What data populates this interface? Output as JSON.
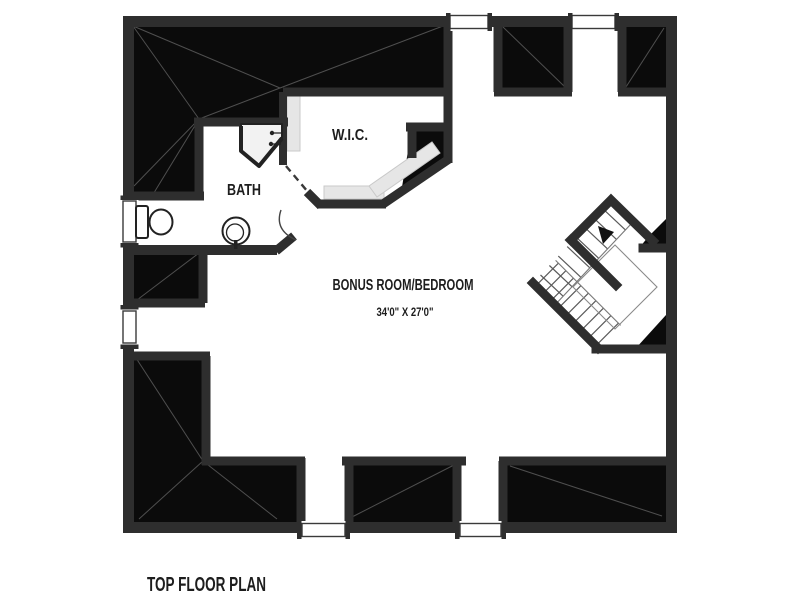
{
  "plan": {
    "name_label": "TOP FLOOR PLAN",
    "rooms": {
      "bath": {
        "label": "BATH"
      },
      "wic": {
        "label": "W.I.C."
      },
      "bonus": {
        "label": "BONUS ROOM/BEDROOM",
        "dimensions": "34'0\" X 27'0\""
      }
    },
    "fixtures": {
      "toilet": "toilet",
      "sink": "pedestal-sink",
      "shower": "corner-shower",
      "stairs": "switchback-staircase",
      "stair_arrow": "up-direction-arrow",
      "closet_shelving": "wic-shelves"
    },
    "window_count": 6,
    "colors": {
      "wall": "#2e2e2e",
      "attic": "#0b0b0b",
      "ridge_line": "#4f4f4f",
      "shelf": "#e6e6e6",
      "shower_fill": "#f2f2f2",
      "text": "#1d1d1d",
      "background": "#ffffff"
    }
  }
}
